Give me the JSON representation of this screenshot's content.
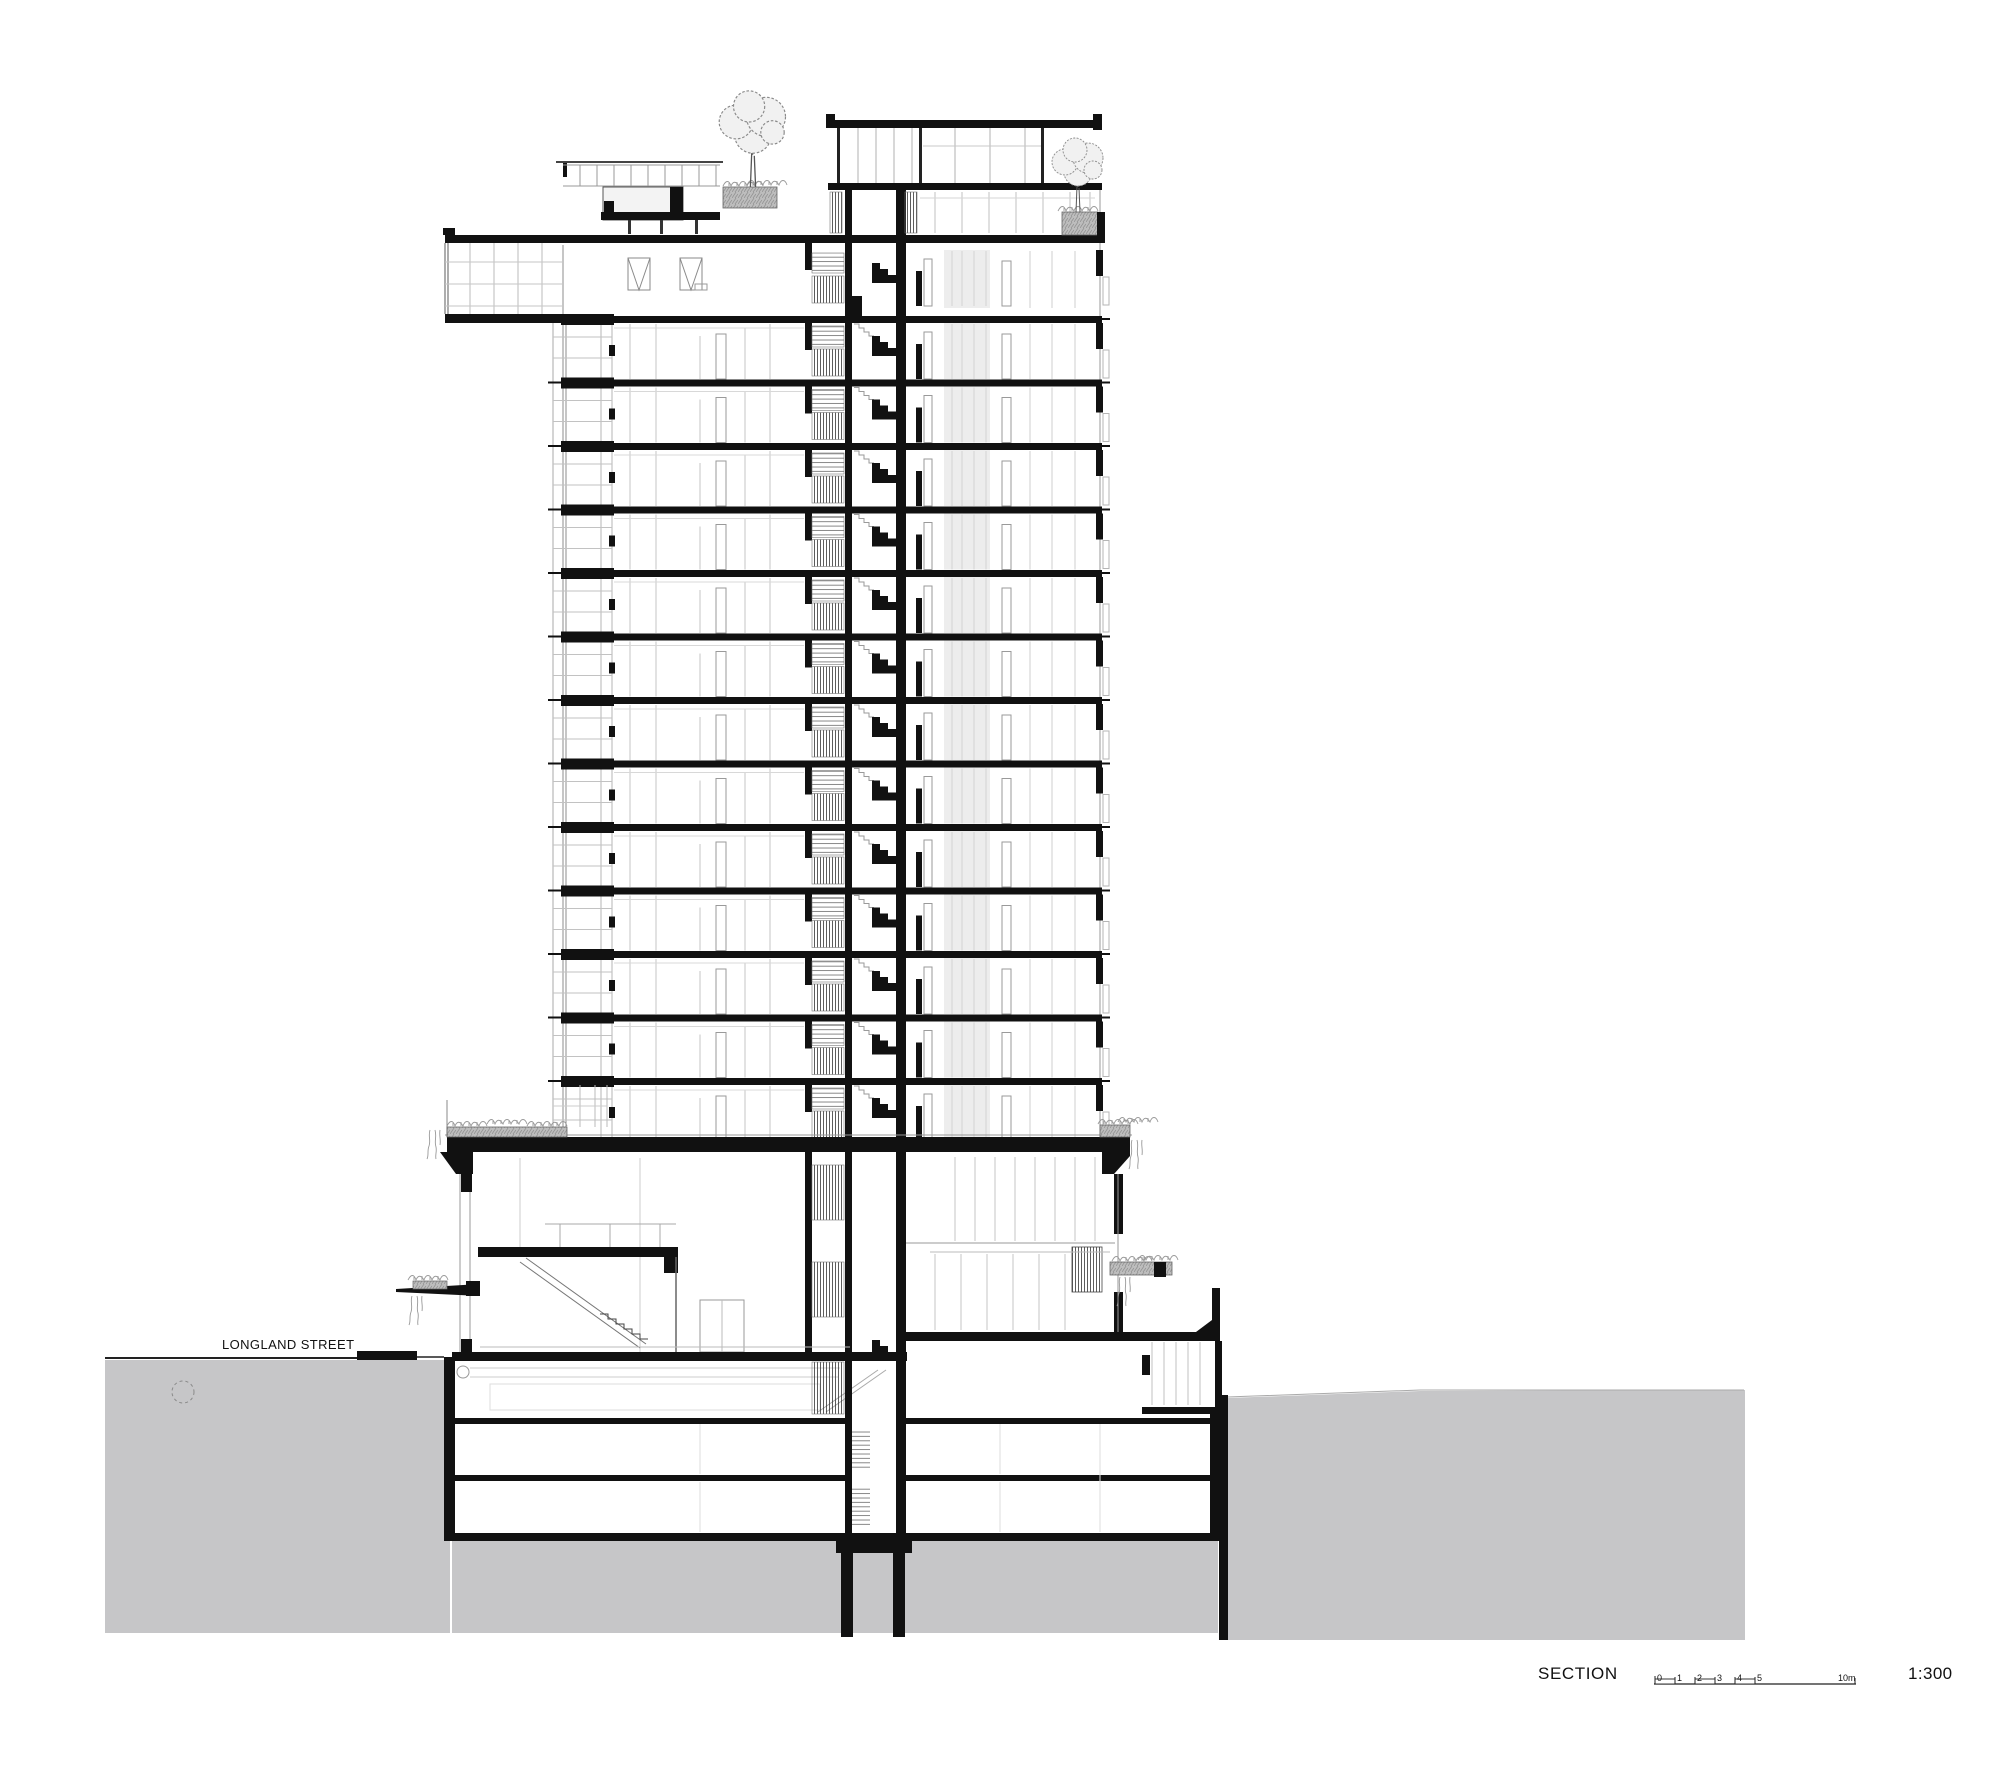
{
  "page": {
    "background": "#ffffff"
  },
  "drawing": {
    "street": {
      "label": "LONGLAND STREET"
    },
    "colors": {
      "line": "#111111",
      "earth": "#c6c6c8",
      "planter": "#bdbdbd",
      "room_tint": "#ededed"
    }
  },
  "footer": {
    "section_label": "SECTION",
    "scale_ratio": "1:300",
    "scale_ticks": [
      "0",
      "1",
      "2",
      "3",
      "4",
      "5"
    ],
    "scale_unit_label": "10m"
  }
}
